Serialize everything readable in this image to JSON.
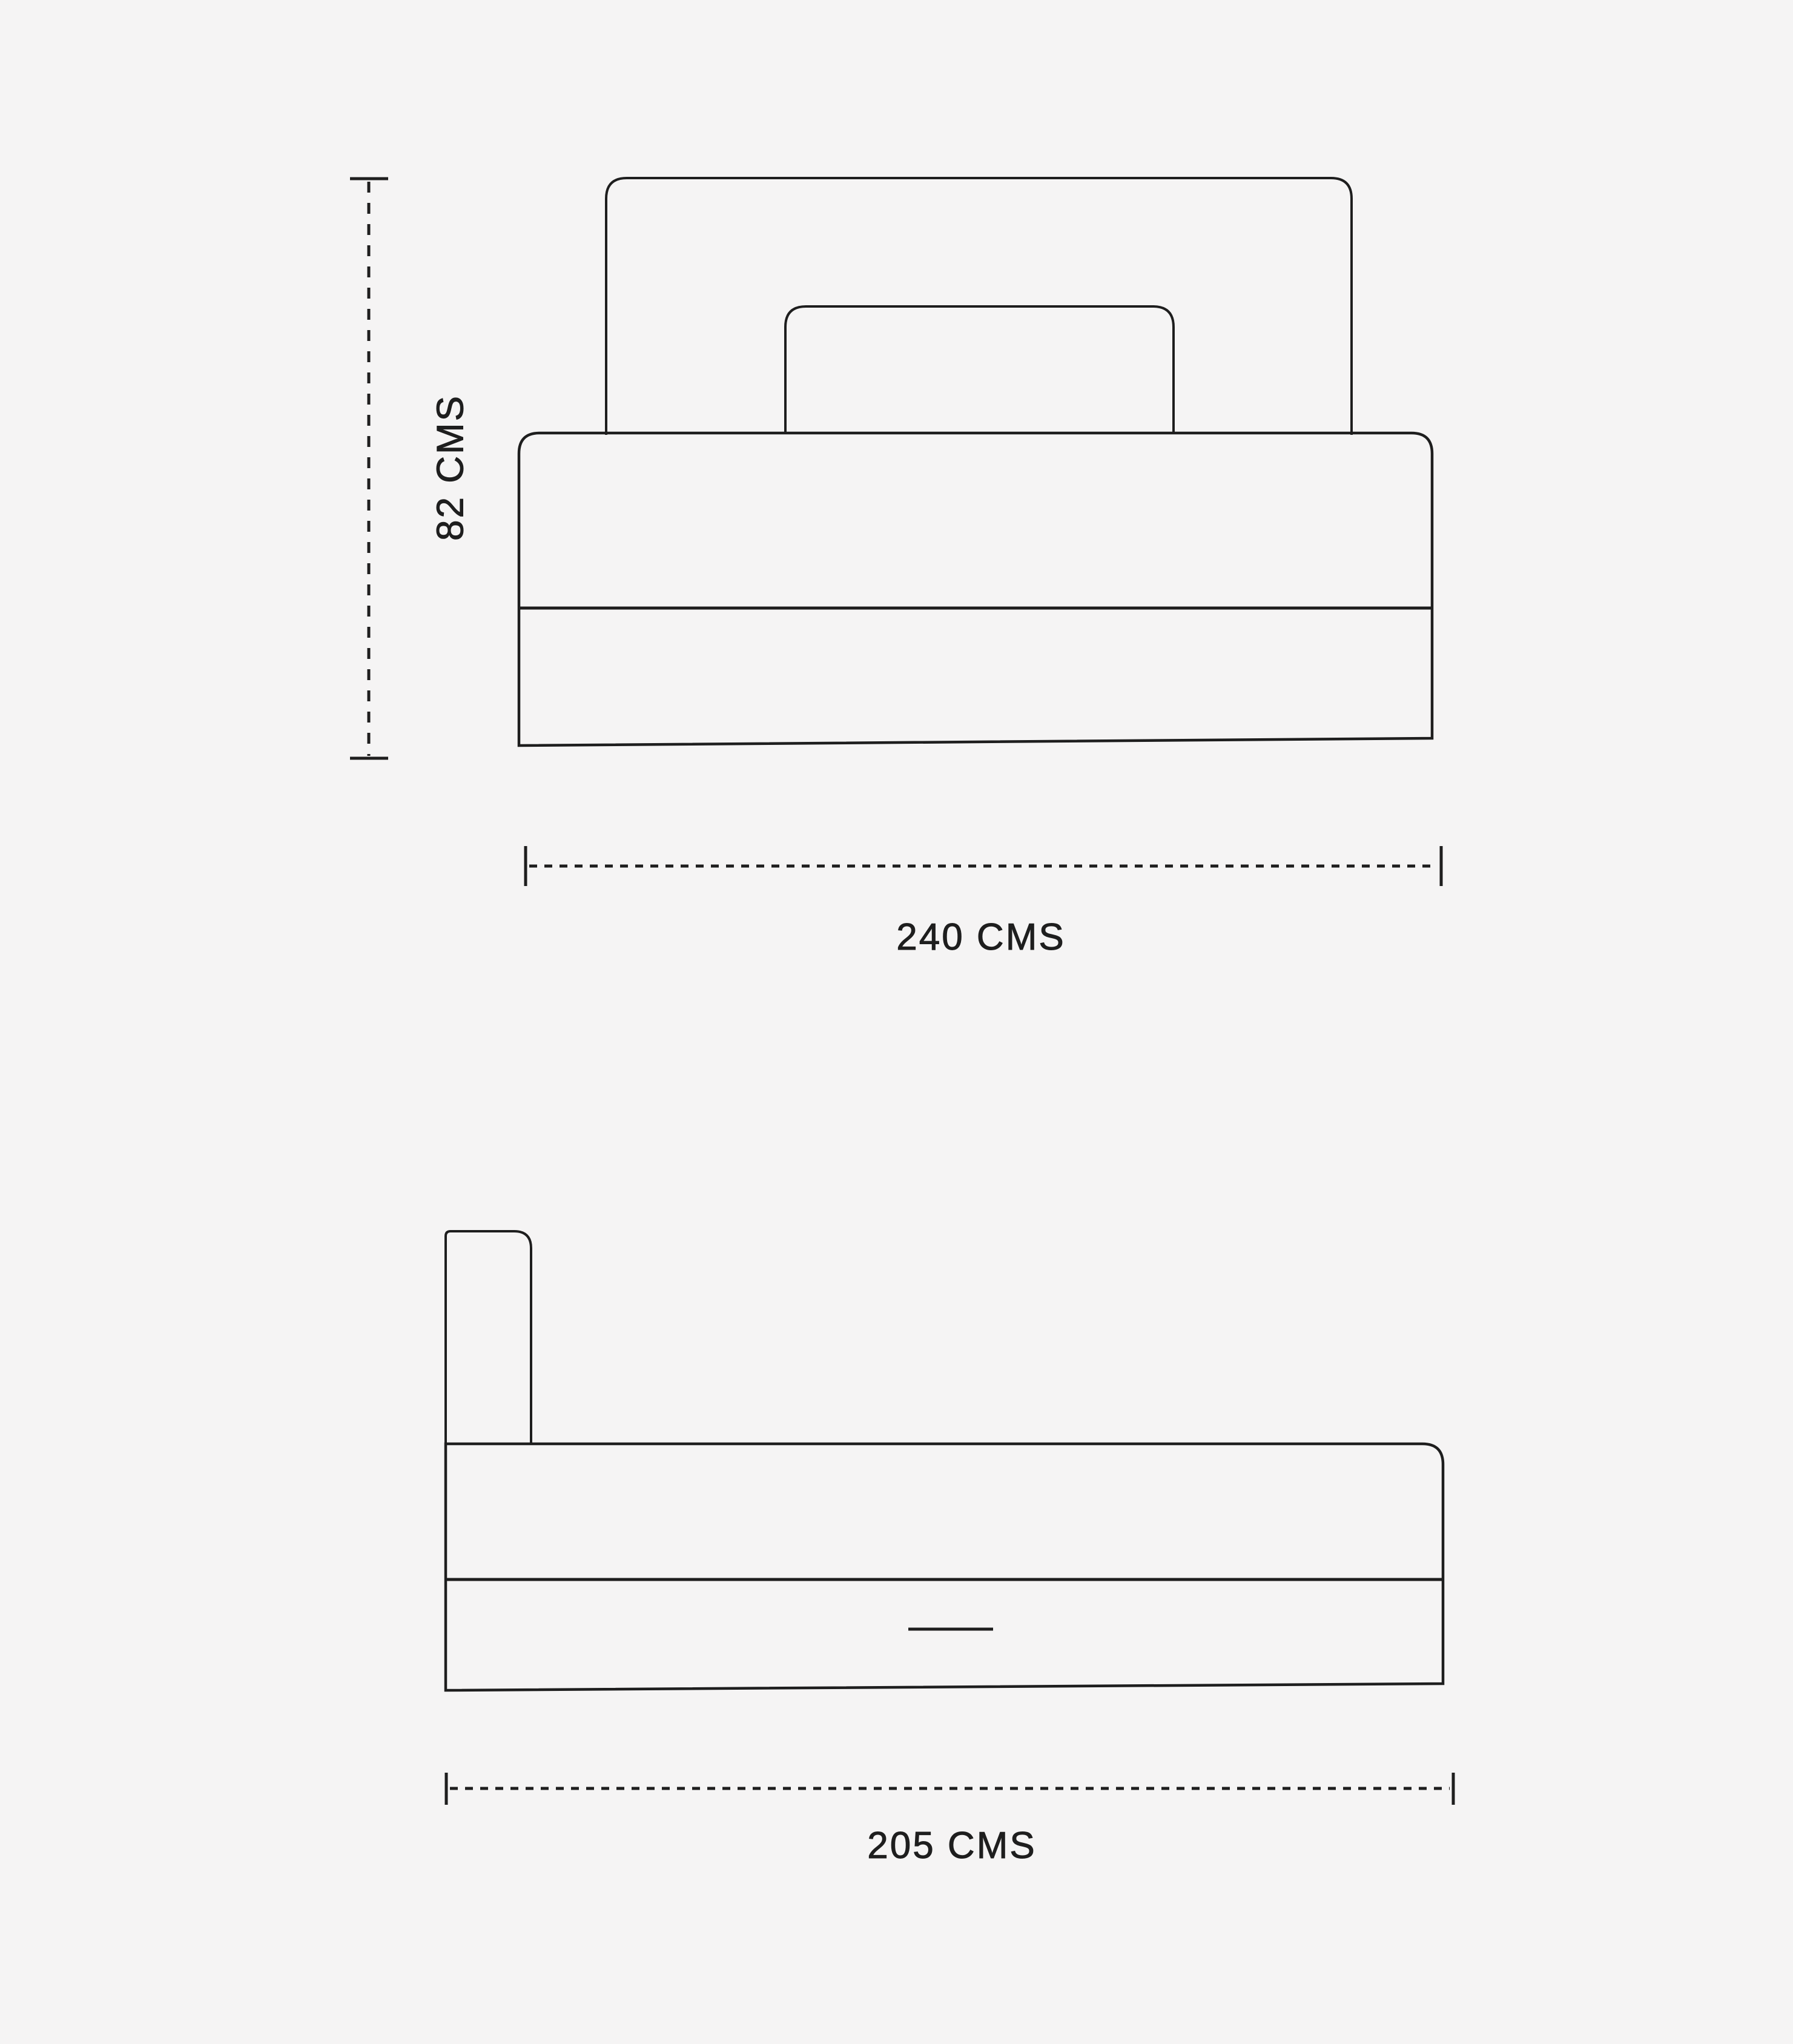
{
  "page": {
    "background_color": "#f5f4f4",
    "line_color": "#1e1e1e",
    "text_color": "#1e1e1e"
  },
  "front_view": {
    "title": "bed front elevation",
    "height_dimension": {
      "label": "82 CMS",
      "value": 82,
      "unit": "CMS"
    },
    "width_dimension": {
      "label": "240 CMS",
      "value": 240,
      "unit": "CMS"
    }
  },
  "side_view": {
    "title": "bed side elevation",
    "depth_dimension": {
      "label": "205 CMS",
      "value": 205,
      "unit": "CMS"
    }
  }
}
